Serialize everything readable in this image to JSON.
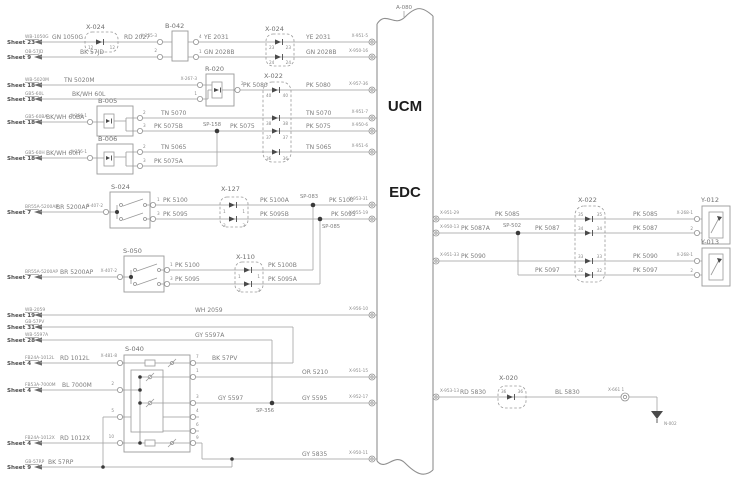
{
  "figure": {
    "ref": "A-080",
    "module_top": "UCM",
    "module_bottom": "EDC"
  },
  "sheets": [
    {
      "sheet": "Sheet 23",
      "code": "WB-1050G"
    },
    {
      "sheet": "Sheet 9",
      "code": "OB-57JD"
    },
    {
      "sheet": "Sheet 18",
      "code": "WB-5020M"
    },
    {
      "sheet": "Sheet 18",
      "code": "GB5-60L"
    },
    {
      "sheet": "Sheet 18",
      "code": "GB5-60BA"
    },
    {
      "sheet": "Sheet 18",
      "code": "GB5-60H"
    },
    {
      "sheet": "Sheet 7",
      "code": "BR55A-5200AP"
    },
    {
      "sheet": "Sheet 7",
      "code": "BR55A-5200AP"
    },
    {
      "sheet": "Sheet 19",
      "code": "WB-2059"
    },
    {
      "sheet": "Sheet 31",
      "code": "GB-57PV"
    },
    {
      "sheet": "Sheet 28",
      "code": "WB-5597A"
    },
    {
      "sheet": "Sheet 4",
      "code": "FB24A-1012L"
    },
    {
      "sheet": "Sheet 4",
      "code": "FB53A-7000M"
    },
    {
      "sheet": "Sheet 4",
      "code": "FB24A-1012X"
    },
    {
      "sheet": "Sheet 9",
      "code": "GB-57RP"
    }
  ],
  "components": {
    "x024": "X-024",
    "b042": "B-042",
    "r020": "R-020",
    "x022": "X-022",
    "b005": "B-005",
    "b006": "B-006",
    "s024": "S-024",
    "x127": "X-127",
    "s050": "S-050",
    "x110": "X-110",
    "s040": "S-040",
    "x020": "X-020",
    "y012": "Y-012",
    "y013": "Y-013",
    "x661": "X-661 1",
    "n002": "N-002"
  },
  "splices": {
    "sp158": "SP-158",
    "sp083": "SP-083",
    "sp085": "SP-085",
    "sp356": "SP-356",
    "sp502": "SP-502"
  },
  "conn_refs": {
    "x255_3": "X-255-3",
    "x267_3": "X-267-3",
    "x266_1": "X-266-1",
    "x256_1": "X-256-1",
    "x407_2": "X-407-2",
    "x481_8": "X-481-8",
    "x268_1": "X-268-1"
  },
  "ucm_pins_left": [
    "X-951-5",
    "X-950-16",
    "X-957-36",
    "X-951-7",
    "X-950-6",
    "X-951-6",
    "X-953-31",
    "X-955-19",
    "X-956-10",
    "X-951-15",
    "X-952-17",
    "X-950-11"
  ],
  "ucm_pins_right": [
    "X-951-29",
    "X-950-13",
    "X-951-33",
    "X-953-13"
  ],
  "wires": {
    "gn1050g": "GN 1050G",
    "rd2027": "RD 2027",
    "ye2031": "YE 2031",
    "gn2028b": "GN 2028B",
    "bk57jd": "BK 57JD",
    "tn5020m": "TN 5020M",
    "bkwh60l": "BK/WH 60L",
    "pk5080": "PK 5080",
    "bkwh60ba": "BK/WH 60BA",
    "tn5070": "TN 5070",
    "pk5075b": "PK 5075B",
    "pk5075": "PK 5075",
    "bkwh60h": "BK/WH 60H",
    "tn5065": "TN 5065",
    "pk5075a": "PK 5075A",
    "br5200ap": "BR 5200AP",
    "pk5100": "PK 5100",
    "pk5095": "PK 5095",
    "pk5100a": "PK 5100A",
    "pk5095b": "PK 5095B",
    "pk5100b": "PK 5100B",
    "pk5095a": "PK 5095A",
    "wh2059": "WH 2059",
    "bk57pv": "BK 57PV",
    "gy5597a": "GY 5597A",
    "rd1012l": "RD 1012L",
    "bl7000m": "BL 7000M",
    "rd1012x": "RD 1012X",
    "bk57rp": "BK 57RP",
    "or5210": "OR 5210",
    "gy5597": "GY 5597",
    "gy5595": "GY 5595",
    "gy5835": "GY 5835",
    "pk5085": "PK 5085",
    "pk5087a": "PK 5087A",
    "pk5087": "PK 5087",
    "pk5090": "PK 5090",
    "pk5097": "PK 5097",
    "rd5830": "RD 5830",
    "bl5830": "BL 5830"
  },
  "pins": {
    "n1": "1",
    "n2": "2",
    "n3": "3",
    "n4": "4",
    "n5": "5",
    "n6": "6",
    "n7": "7",
    "n9": "9",
    "n10": "10",
    "n12": "12",
    "n23": "23",
    "n24": "24",
    "n32": "32",
    "n33": "33",
    "n34": "34",
    "n35": "35",
    "n36": "36",
    "n37": "37",
    "n38": "38",
    "n40": "40"
  }
}
